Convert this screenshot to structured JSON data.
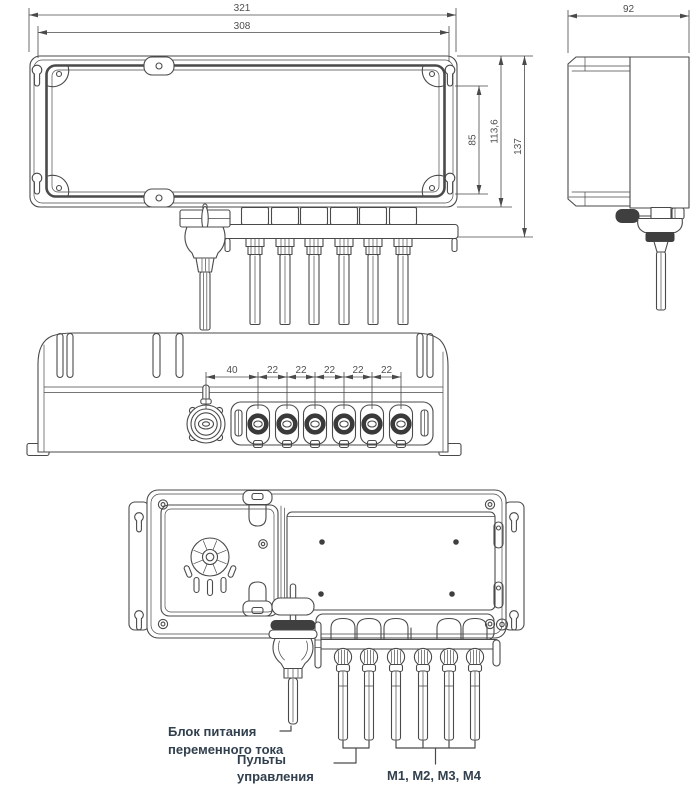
{
  "drawing": {
    "front_view": {
      "dim_outer_width": "321",
      "dim_mount_width": "308",
      "dim_mount_pitch_v": "85",
      "dim_body_height": "113,6",
      "dim_total_height": "137"
    },
    "side_view": {
      "dim_depth": "92"
    },
    "bottom_view": {
      "dim_power_offset": "40",
      "dim_pitch": [
        "22",
        "22",
        "22",
        "22",
        "22"
      ]
    },
    "top_view": {
      "label_power_1": "Блок питания",
      "label_power_2": "переменного тока",
      "label_remotes_1": "Пульты",
      "label_remotes_2": "управления",
      "label_motors": "М1, М2, М3, М4"
    },
    "colors": {
      "line": "#4a4a4a",
      "dim_text": "#4f4f4f",
      "label_text": "#32404e"
    }
  }
}
